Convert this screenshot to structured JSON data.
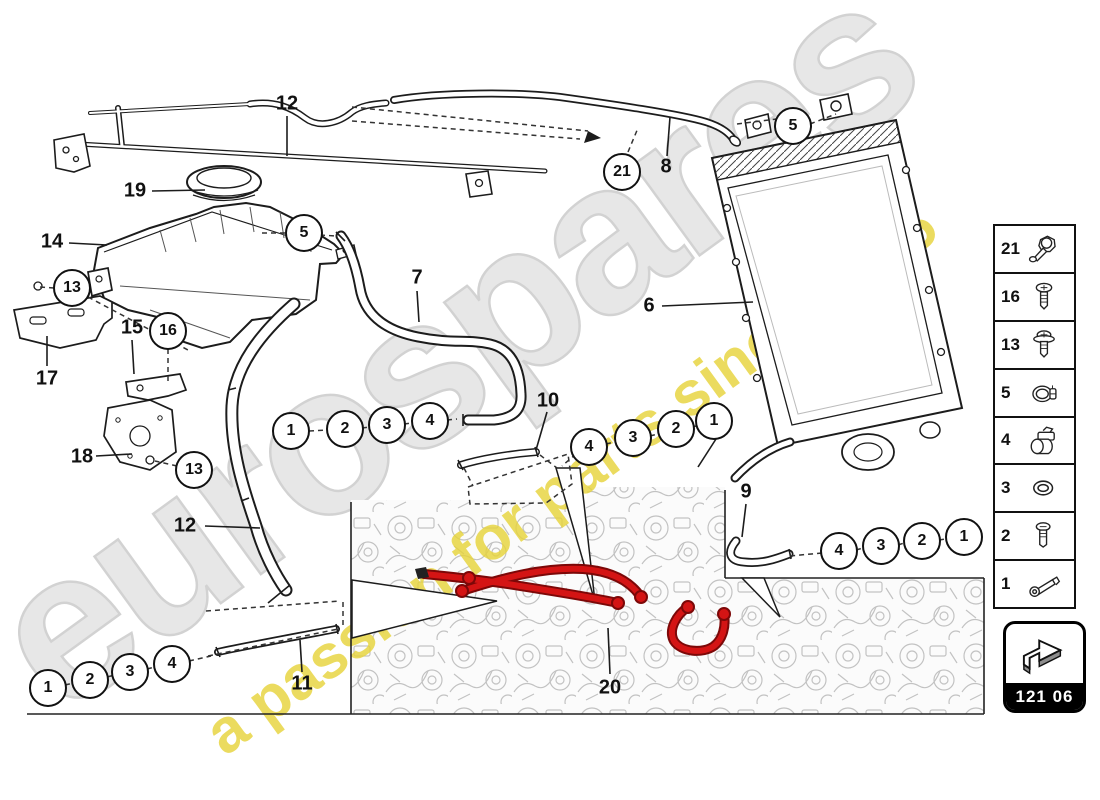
{
  "brand": {
    "watermark_text": "eurospares",
    "tagline": "a passion for parts since 1985"
  },
  "diagram_code": {
    "label": "121 06"
  },
  "colors": {
    "highlight_red": "#d41414",
    "highlight_red_dark": "#7c0808",
    "watermark_gray": "#e6e6e6",
    "watermark_yellow": "#e7d43c",
    "line": "#1a1a1a"
  },
  "sidebar": {
    "items": [
      {
        "label": "21",
        "icon": "spring-clip-icon"
      },
      {
        "label": "16",
        "icon": "screw-icon"
      },
      {
        "label": "13",
        "icon": "flanged-screw-icon"
      },
      {
        "label": "5",
        "icon": "hose-clamp-icon"
      },
      {
        "label": "4",
        "icon": "pipe-clip-icon"
      },
      {
        "label": "3",
        "icon": "seal-ring-icon"
      },
      {
        "label": "2",
        "icon": "bolt-icon"
      },
      {
        "label": "1",
        "icon": "banjo-bolt-icon"
      }
    ]
  },
  "callouts": {
    "circled": [
      {
        "label": "13",
        "x": 72,
        "y": 288
      },
      {
        "label": "16",
        "x": 168,
        "y": 331
      },
      {
        "label": "13",
        "x": 194,
        "y": 470
      },
      {
        "label": "5",
        "x": 304,
        "y": 233
      },
      {
        "label": "5",
        "x": 793,
        "y": 126
      },
      {
        "label": "21",
        "x": 622,
        "y": 172
      },
      {
        "label": "1",
        "x": 291,
        "y": 431
      },
      {
        "label": "2",
        "x": 345,
        "y": 429
      },
      {
        "label": "3",
        "x": 387,
        "y": 425
      },
      {
        "label": "4",
        "x": 430,
        "y": 421
      },
      {
        "label": "4",
        "x": 589,
        "y": 447
      },
      {
        "label": "3",
        "x": 633,
        "y": 438
      },
      {
        "label": "2",
        "x": 676,
        "y": 429
      },
      {
        "label": "1",
        "x": 714,
        "y": 421
      },
      {
        "label": "4",
        "x": 839,
        "y": 551
      },
      {
        "label": "3",
        "x": 881,
        "y": 546
      },
      {
        "label": "2",
        "x": 922,
        "y": 541
      },
      {
        "label": "1",
        "x": 964,
        "y": 537
      },
      {
        "label": "1",
        "x": 48,
        "y": 688
      },
      {
        "label": "2",
        "x": 90,
        "y": 680
      },
      {
        "label": "3",
        "x": 130,
        "y": 672
      },
      {
        "label": "4",
        "x": 172,
        "y": 664
      }
    ],
    "plain": [
      {
        "label": "12",
        "x": 287,
        "y": 104
      },
      {
        "label": "19",
        "x": 135,
        "y": 191
      },
      {
        "label": "14",
        "x": 52,
        "y": 242
      },
      {
        "label": "7",
        "x": 417,
        "y": 278
      },
      {
        "label": "6",
        "x": 649,
        "y": 306
      },
      {
        "label": "8",
        "x": 666,
        "y": 167
      },
      {
        "label": "10",
        "x": 548,
        "y": 401
      },
      {
        "label": "9",
        "x": 746,
        "y": 492
      },
      {
        "label": "11",
        "x": 302,
        "y": 684
      },
      {
        "label": "20",
        "x": 610,
        "y": 688
      },
      {
        "label": "17",
        "x": 47,
        "y": 379
      },
      {
        "label": "15",
        "x": 132,
        "y": 328
      },
      {
        "label": "18",
        "x": 82,
        "y": 457
      },
      {
        "label": "12",
        "x": 185,
        "y": 526
      }
    ]
  }
}
